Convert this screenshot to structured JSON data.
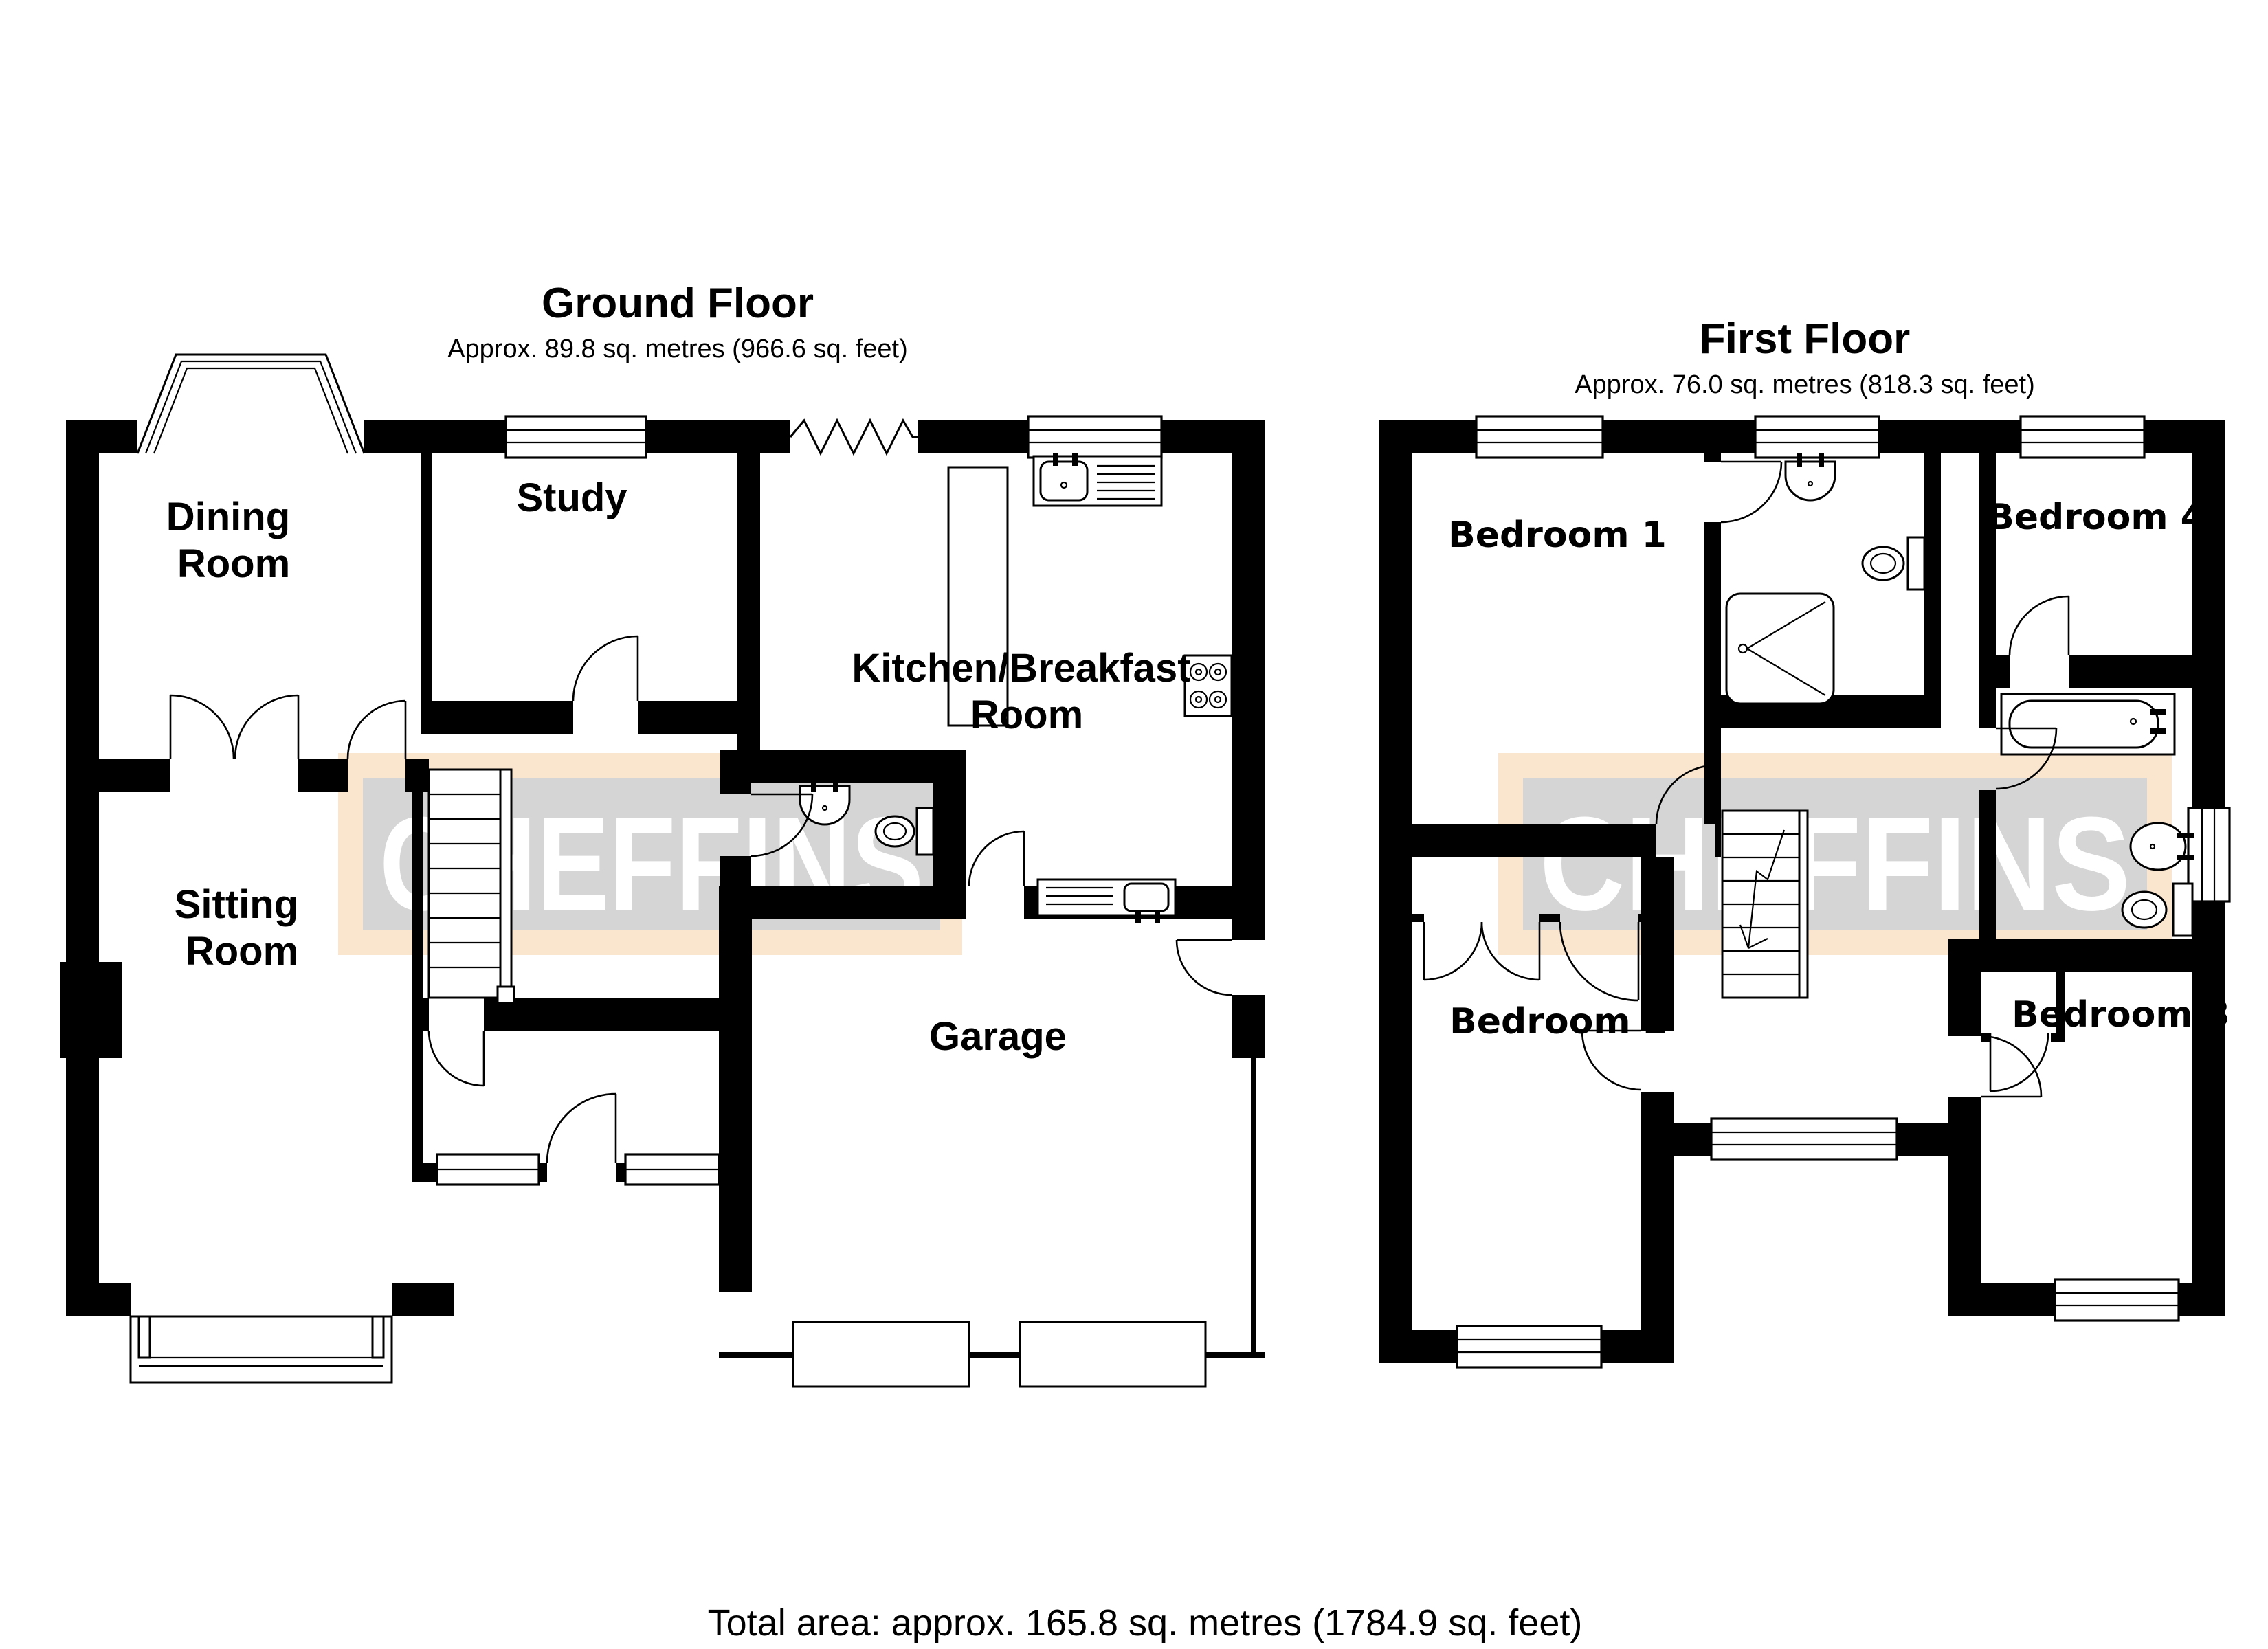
{
  "colors": {
    "wall": "#000000",
    "watermark_band": "#fae5cf",
    "watermark_panel": "#d5d5d5",
    "watermark_letters": "#ffffff"
  },
  "watermark": {
    "text": "CHEFFINS"
  },
  "ground_floor": {
    "title": "Ground Floor",
    "area_label": "Approx. 89.8 sq. metres (966.6 sq. feet)",
    "rooms": {
      "dining": {
        "lines": [
          "Dining",
          "Room"
        ]
      },
      "study": {
        "lines": [
          "Study"
        ]
      },
      "kitchen": {
        "lines": [
          "Kitchen/Breakfast",
          "Room"
        ]
      },
      "sitting": {
        "lines": [
          "Sitting",
          "Room"
        ]
      },
      "garage": {
        "lines": [
          "Garage"
        ]
      }
    }
  },
  "first_floor": {
    "title": "First Floor",
    "area_label": "Approx. 76.0 sq. metres (818.3 sq. feet)",
    "rooms": {
      "bedroom1": {
        "lines": [
          "Bedroom 1"
        ]
      },
      "bedroom2": {
        "lines": [
          "Bedroom 2"
        ]
      },
      "bedroom3": {
        "lines": [
          "Bedroom 3"
        ]
      },
      "bedroom4": {
        "lines": [
          "Bedroom 4"
        ]
      }
    }
  },
  "footer": {
    "total_area": "Total area: approx. 165.8 sq. metres (1784.9 sq. feet)"
  }
}
